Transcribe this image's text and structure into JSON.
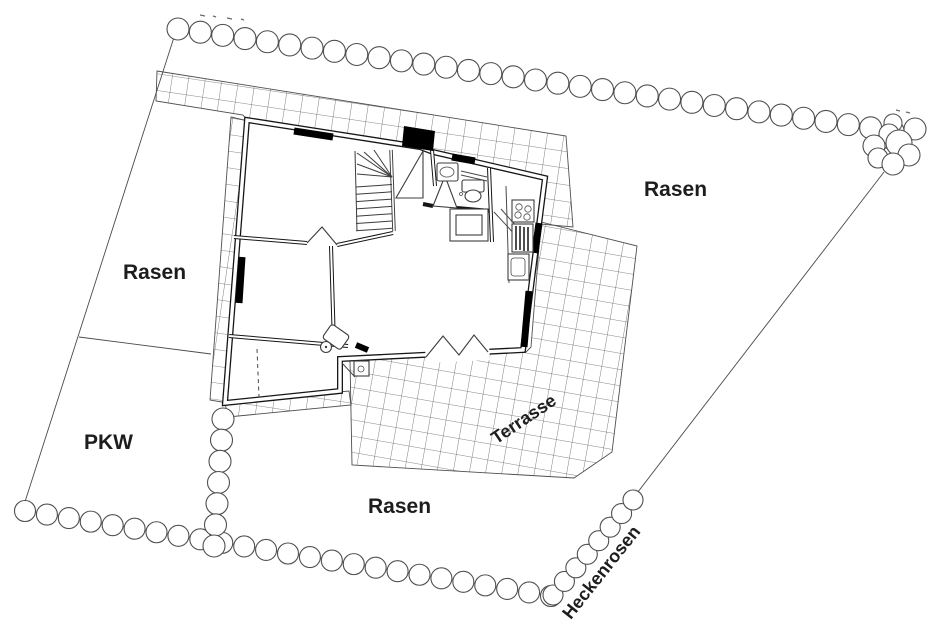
{
  "document": {
    "type": "site-plan-drawing",
    "title": "Lageplan Grundstück mit Haus"
  },
  "labels": {
    "lawn_left": "Rasen",
    "lawn_right": "Rasen",
    "lawn_bottom": "Rasen",
    "parking": "PKW",
    "terrace": "Terrasse",
    "hedge_roses": "Heckenrosen"
  },
  "legend": {
    "hedge_circles": "hedge/shrub border",
    "grid_tiles": "paved tiles (walkway and terrace)",
    "black_bars": "windows",
    "black_rect": "chimney"
  },
  "colors": {
    "background": "#ffffff",
    "line": "#4a4a4a",
    "wall": "#161616",
    "window_fill": "#000000",
    "label": "#1d1d1d"
  }
}
